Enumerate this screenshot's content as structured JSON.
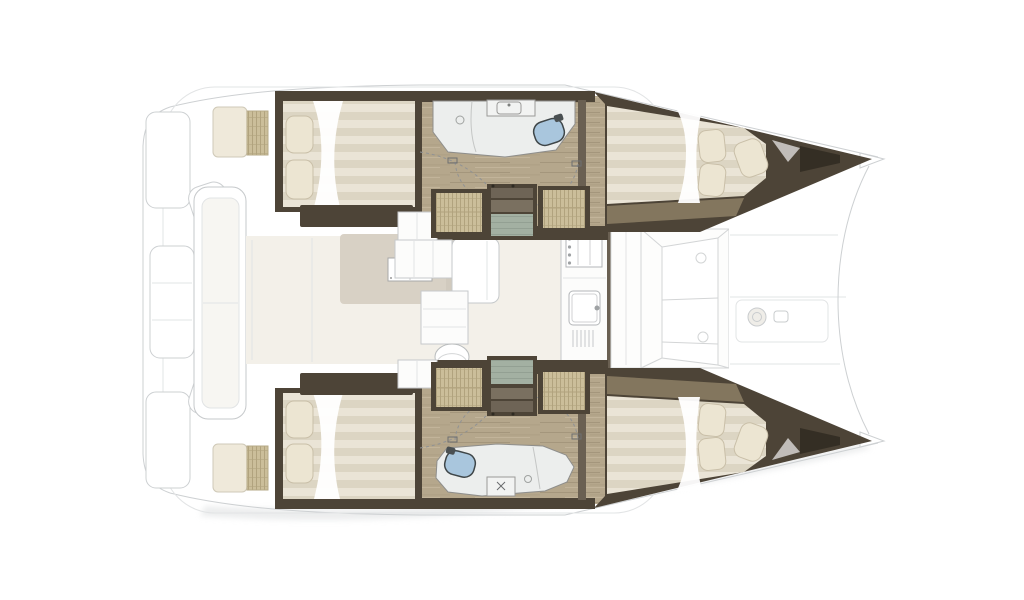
{
  "image": {
    "type": "floorplan",
    "subject": "catamaran sailing yacht interior layout, top-down view, bows pointing right",
    "visible_text": ""
  },
  "palette": {
    "background": "#ffffff",
    "outline": "#cdd0d2",
    "outline_light": "#e2e4e5",
    "shadow": "#dcdedf",
    "hull_wall": "#4d4437",
    "hull_wall_light": "#6a6052",
    "footboard_tan": "#8a7c63",
    "wood_floor": "#b5a78c",
    "wood_grain": "#a4967c",
    "wood_grain_light": "#c2b49a",
    "wicker": "#cbbe9a",
    "wicker_stripe": "#b1a37e",
    "step_teal": "#a3b0a2",
    "step_teal_line": "#93a093",
    "step_brown": "#6e6456",
    "mattress": "#eae4d6",
    "mattress_stripe": "#dcd5c3",
    "duvet_white": "#ffffff",
    "pillow": "#ece5d2",
    "pillow_edge": "#c9bfa8",
    "toilet_blue": "#a9c6dd",
    "fixture_stroke": "#8e8e8c",
    "bathroom_floor": "#eceeed",
    "salon_floor": "#f3f0e9",
    "rug": "#d8d1c5",
    "rug_shade": "#cfc8bb",
    "furniture_white": "#fcfcfb",
    "furniture_stroke": "#c6c9cb",
    "cushion_cream": "#efe9da",
    "door_arc": "#909294",
    "anchor_dark": "#322c22"
  },
  "inventory": {
    "hulls": 2,
    "double_beds": 4,
    "bathrooms": 2,
    "toilets": 2,
    "companionway_stairs": 2,
    "wicker_cabinets": 4,
    "salon_table": 1,
    "salon_sofa": 1,
    "galley_stove": 1,
    "galley_sink": 1,
    "foredeck_winch": 1,
    "cockpit_bench": 1
  }
}
